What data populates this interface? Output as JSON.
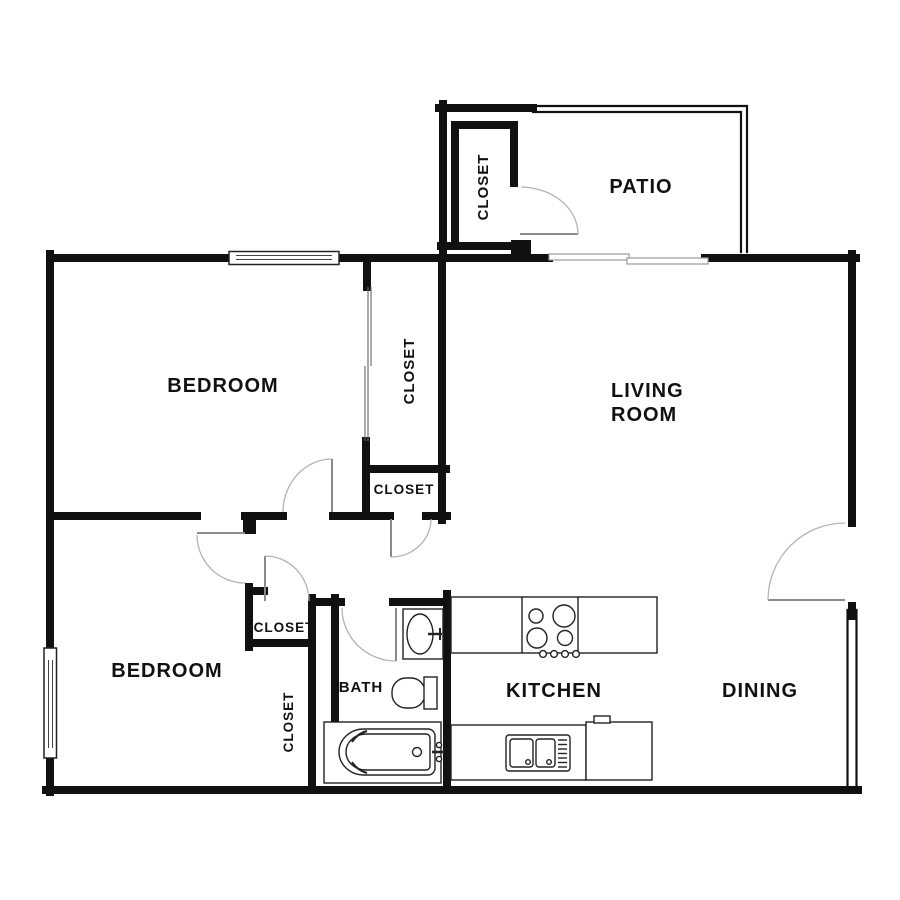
{
  "floor_plan": {
    "title": "apartment-floor-plan",
    "rooms": {
      "patio": "PATIO",
      "closet_top": "CLOSET",
      "bedroom1": "BEDROOM",
      "closet_bedroom1": "CLOSET",
      "closet_hall": "CLOSET",
      "living_line1": "LIVING",
      "living_line2": "ROOM",
      "bedroom2": "BEDROOM",
      "closet_bedroom2_small": "CLOSET",
      "closet_bedroom2_tall": "CLOSET",
      "bath": "BATH",
      "kitchen": "KITCHEN",
      "dining": "DINING"
    },
    "colors": {
      "wall": "#111111",
      "door_arc": "#b3b3b3",
      "fixture": "#222222",
      "background": "#ffffff"
    }
  }
}
